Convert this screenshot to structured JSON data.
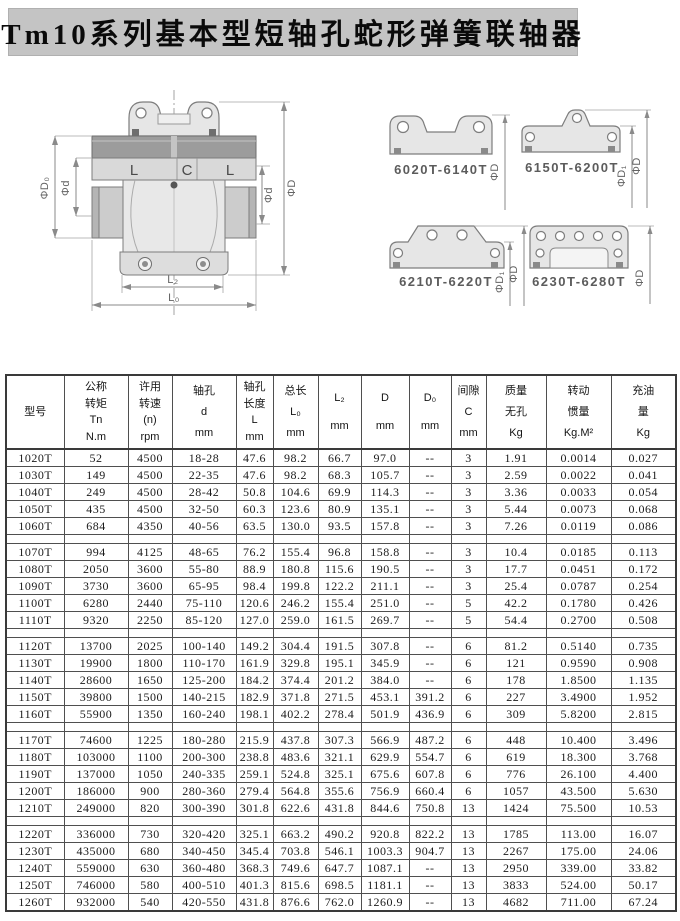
{
  "page": {
    "title": "Tm10系列基本型短轴孔蛇形弹簧联轴器"
  },
  "main_diagram": {
    "labels": {
      "phi_d0": "ΦD₀",
      "phi_d_left": "Φd",
      "l_left": "L",
      "c_center": "C",
      "l_right": "L",
      "phi_d_right": "Φd",
      "phi_big_d": "ΦD",
      "l2": "L₂",
      "l0": "L₀"
    }
  },
  "variants": [
    {
      "range": "6020T-6140T",
      "dims": {
        "d": "ΦD"
      }
    },
    {
      "range": "6150T-6200T",
      "dims": {
        "d1": "ΦD₁",
        "d": "ΦD"
      }
    },
    {
      "range": "6210T-6220T",
      "dims": {
        "d1": "ΦD₁",
        "d": "ΦD"
      }
    },
    {
      "range": "6230T-6280T",
      "dims": {
        "d": "ΦD"
      }
    }
  ],
  "table": {
    "col_ids": [
      "model",
      "nominal-torque",
      "allowable-speed",
      "bore-d",
      "bore-length",
      "total-length",
      "l2",
      "d",
      "d0",
      "clearance",
      "mass",
      "inertia",
      "oil-fill"
    ],
    "headers": [
      [
        "型号"
      ],
      [
        "公称",
        "转矩",
        "Tn",
        "N.m"
      ],
      [
        "许用",
        "转速",
        "(n)",
        "rpm"
      ],
      [
        "轴孔",
        "d",
        "mm"
      ],
      [
        "轴孔",
        "长度",
        "L",
        "mm"
      ],
      [
        "总长",
        "L₀",
        "mm"
      ],
      [
        "L₂",
        "mm"
      ],
      [
        "D",
        "mm"
      ],
      [
        "D₀",
        "mm"
      ],
      [
        "间隙",
        "C",
        "mm"
      ],
      [
        "质量",
        "无孔",
        "Kg"
      ],
      [
        "转动",
        "惯量",
        "Kg.M²"
      ],
      [
        "充油",
        "量",
        "Kg"
      ]
    ],
    "groups": [
      {
        "rows": [
          [
            "1020T",
            "52",
            "4500",
            "18-28",
            "47.6",
            "98.2",
            "66.7",
            "97.0",
            "--",
            "3",
            "1.91",
            "0.0014",
            "0.027"
          ],
          [
            "1030T",
            "149",
            "4500",
            "22-35",
            "47.6",
            "98.2",
            "68.3",
            "105.7",
            "--",
            "3",
            "2.59",
            "0.0022",
            "0.041"
          ],
          [
            "1040T",
            "249",
            "4500",
            "28-42",
            "50.8",
            "104.6",
            "69.9",
            "114.3",
            "--",
            "3",
            "3.36",
            "0.0033",
            "0.054"
          ],
          [
            "1050T",
            "435",
            "4500",
            "32-50",
            "60.3",
            "123.6",
            "80.9",
            "135.1",
            "--",
            "3",
            "5.44",
            "0.0073",
            "0.068"
          ],
          [
            "1060T",
            "684",
            "4350",
            "40-56",
            "63.5",
            "130.0",
            "93.5",
            "157.8",
            "--",
            "3",
            "7.26",
            "0.0119",
            "0.086"
          ]
        ]
      },
      {
        "rows": [
          [
            "1070T",
            "994",
            "4125",
            "48-65",
            "76.2",
            "155.4",
            "96.8",
            "158.8",
            "--",
            "3",
            "10.4",
            "0.0185",
            "0.113"
          ],
          [
            "1080T",
            "2050",
            "3600",
            "55-80",
            "88.9",
            "180.8",
            "115.6",
            "190.5",
            "--",
            "3",
            "17.7",
            "0.0451",
            "0.172"
          ],
          [
            "1090T",
            "3730",
            "3600",
            "65-95",
            "98.4",
            "199.8",
            "122.2",
            "211.1",
            "--",
            "3",
            "25.4",
            "0.0787",
            "0.254"
          ],
          [
            "1100T",
            "6280",
            "2440",
            "75-110",
            "120.6",
            "246.2",
            "155.4",
            "251.0",
            "--",
            "5",
            "42.2",
            "0.1780",
            "0.426"
          ],
          [
            "1110T",
            "9320",
            "2250",
            "85-120",
            "127.0",
            "259.0",
            "161.5",
            "269.7",
            "--",
            "5",
            "54.4",
            "0.2700",
            "0.508"
          ]
        ]
      },
      {
        "rows": [
          [
            "1120T",
            "13700",
            "2025",
            "100-140",
            "149.2",
            "304.4",
            "191.5",
            "307.8",
            "--",
            "6",
            "81.2",
            "0.5140",
            "0.735"
          ],
          [
            "1130T",
            "19900",
            "1800",
            "110-170",
            "161.9",
            "329.8",
            "195.1",
            "345.9",
            "--",
            "6",
            "121",
            "0.9590",
            "0.908"
          ],
          [
            "1140T",
            "28600",
            "1650",
            "125-200",
            "184.2",
            "374.4",
            "201.2",
            "384.0",
            "--",
            "6",
            "178",
            "1.8500",
            "1.135"
          ],
          [
            "1150T",
            "39800",
            "1500",
            "140-215",
            "182.9",
            "371.8",
            "271.5",
            "453.1",
            "391.2",
            "6",
            "227",
            "3.4900",
            "1.952"
          ],
          [
            "1160T",
            "55900",
            "1350",
            "160-240",
            "198.1",
            "402.2",
            "278.4",
            "501.9",
            "436.9",
            "6",
            "309",
            "5.8200",
            "2.815"
          ]
        ]
      },
      {
        "rows": [
          [
            "1170T",
            "74600",
            "1225",
            "180-280",
            "215.9",
            "437.8",
            "307.3",
            "566.9",
            "487.2",
            "6",
            "448",
            "10.400",
            "3.496"
          ],
          [
            "1180T",
            "103000",
            "1100",
            "200-300",
            "238.8",
            "483.6",
            "321.1",
            "629.9",
            "554.7",
            "6",
            "619",
            "18.300",
            "3.768"
          ],
          [
            "1190T",
            "137000",
            "1050",
            "240-335",
            "259.1",
            "524.8",
            "325.1",
            "675.6",
            "607.8",
            "6",
            "776",
            "26.100",
            "4.400"
          ],
          [
            "1200T",
            "186000",
            "900",
            "280-360",
            "279.4",
            "564.8",
            "355.6",
            "756.9",
            "660.4",
            "6",
            "1057",
            "43.500",
            "5.630"
          ],
          [
            "1210T",
            "249000",
            "820",
            "300-390",
            "301.8",
            "622.6",
            "431.8",
            "844.6",
            "750.8",
            "13",
            "1424",
            "75.500",
            "10.53"
          ]
        ]
      },
      {
        "rows": [
          [
            "1220T",
            "336000",
            "730",
            "320-420",
            "325.1",
            "663.2",
            "490.2",
            "920.8",
            "822.2",
            "13",
            "1785",
            "113.00",
            "16.07"
          ],
          [
            "1230T",
            "435000",
            "680",
            "340-450",
            "345.4",
            "703.8",
            "546.1",
            "1003.3",
            "904.7",
            "13",
            "2267",
            "175.00",
            "24.06"
          ],
          [
            "1240T",
            "559000",
            "630",
            "360-480",
            "368.3",
            "749.6",
            "647.7",
            "1087.1",
            "--",
            "13",
            "2950",
            "339.00",
            "33.82"
          ],
          [
            "1250T",
            "746000",
            "580",
            "400-510",
            "401.3",
            "815.6",
            "698.5",
            "1181.1",
            "--",
            "13",
            "3833",
            "524.00",
            "50.17"
          ],
          [
            "1260T",
            "932000",
            "540",
            "420-550",
            "431.8",
            "876.6",
            "762.0",
            "1260.9",
            "--",
            "13",
            "4682",
            "711.00",
            "67.24"
          ]
        ]
      }
    ]
  }
}
